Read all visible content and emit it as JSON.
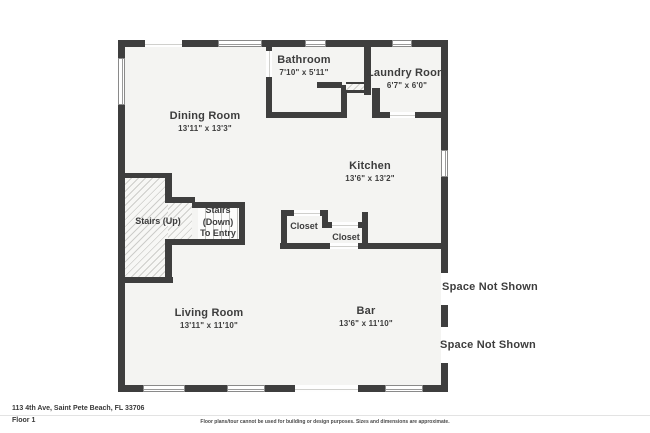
{
  "plan": {
    "rooms": {
      "dining": {
        "name": "Dining Room",
        "dims": "13'11\" x 13'3\""
      },
      "bathroom": {
        "name": "Bathroom",
        "dims": "7'10\" x 5'11\""
      },
      "laundry": {
        "name": "Laundry Room",
        "dims": "6'7\" x 6'0\""
      },
      "kitchen": {
        "name": "Kitchen",
        "dims": "13'6\" x 13'2\""
      },
      "living": {
        "name": "Living Room",
        "dims": "13'11\" x 11'10\""
      },
      "bar": {
        "name": "Bar",
        "dims": "13'6\" x 11'10\""
      },
      "stairs_up": {
        "name": "Stairs (Up)"
      },
      "stairs_down": {
        "line1": "Stairs",
        "line2": "(Down)",
        "line3": "To Entry"
      },
      "closet_a": {
        "name": "Closet"
      },
      "closet_b": {
        "name": "Closet"
      },
      "space_not_shown_1": {
        "name": "Space Not Shown"
      },
      "space_not_shown_2": {
        "name": "Space Not Shown"
      }
    },
    "colors": {
      "wall": "#3e3e3e",
      "room_fill": "#f4f4f2",
      "text": "#3d3d3d"
    }
  },
  "footer": {
    "address": "113 4th Ave, Saint Pete Beach, FL 33706",
    "floor": "Floor 1",
    "disclaimer": "Floor plans/tour cannot be used for building or design purposes. Sizes and dimensions are approximate."
  }
}
